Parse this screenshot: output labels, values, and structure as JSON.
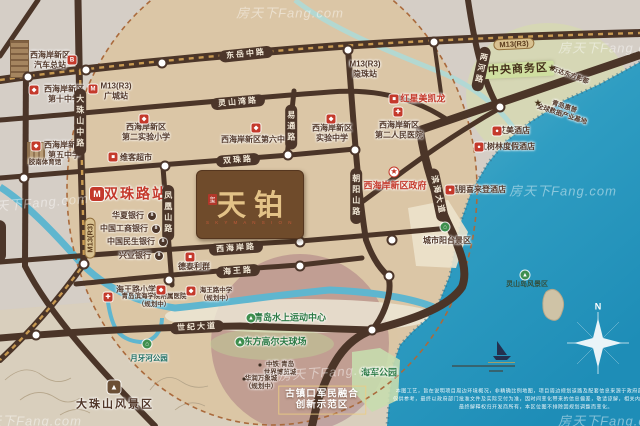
{
  "brand": {
    "seal": "玺",
    "title": "天铂",
    "subtitle": "S K Y   M A N S I O N"
  },
  "watermark_text": "房天下Fang.com",
  "colors": {
    "road": "#4b3528",
    "metro_dash": "#c89a52",
    "sea_top": "#5fb6cc",
    "sea_deep": "#1e8db7",
    "circle_fill": "#dbc6a3",
    "circle_border": "#aa6a3c",
    "accent_red": "#c4392b",
    "poi_brown": "#52382a"
  },
  "map": {
    "road_labels": [
      {
        "name": "road-label-dongyue-middle-rd",
        "lines": [
          "东岳中路"
        ],
        "x": 246,
        "y": 54,
        "rot": -6,
        "style": "capsule"
      },
      {
        "name": "road-label-lingshanwan-rd",
        "lines": [
          "灵山湾路"
        ],
        "x": 238,
        "y": 102,
        "rot": -5,
        "style": "capsule"
      },
      {
        "name": "road-label-shuangzhu-rd",
        "lines": [
          "双珠路"
        ],
        "x": 238,
        "y": 160,
        "rot": -4,
        "style": "capsule"
      },
      {
        "name": "road-label-xihaian-rd",
        "lines": [
          "西海岸路"
        ],
        "x": 236,
        "y": 248,
        "rot": -4,
        "style": "capsule"
      },
      {
        "name": "road-label-haiwang-rd",
        "lines": [
          "海王路"
        ],
        "x": 238,
        "y": 271,
        "rot": -4,
        "style": "capsule"
      },
      {
        "name": "road-label-shiji-ave",
        "lines": [
          "世纪大道"
        ],
        "x": 197,
        "y": 327,
        "rot": -3,
        "style": "capsule"
      },
      {
        "name": "road-label-binhai-ave",
        "lines": [
          "滨海大道"
        ],
        "x": 438,
        "y": 195,
        "rot": 78,
        "style": "capsule"
      },
      {
        "name": "road-label-dazhushan-middle-rd",
        "lines": [
          "大珠山中路"
        ],
        "x": 80,
        "y": 122,
        "rot": 0,
        "style": "capsule-v"
      },
      {
        "name": "road-label-fenghuangshan-rd",
        "lines": [
          "凤凰山路"
        ],
        "x": 168,
        "y": 213,
        "rot": 0,
        "style": "capsule-v"
      },
      {
        "name": "road-label-yitong-rd",
        "lines": [
          "易通路"
        ],
        "x": 291,
        "y": 127,
        "rot": 0,
        "style": "capsule-v"
      },
      {
        "name": "road-label-chaoyangshan-rd",
        "lines": [
          "朝阳山路"
        ],
        "x": 356,
        "y": 196,
        "rot": 0,
        "style": "capsule-v"
      },
      {
        "name": "road-label-lianghe-rd",
        "lines": [
          "两河路"
        ],
        "x": 481,
        "y": 69,
        "rot": 12,
        "style": "capsule-v"
      },
      {
        "name": "metro-badge-m13-top",
        "lines": [
          "M13(R3)"
        ],
        "x": 514,
        "y": 44,
        "rot": -3,
        "style": "metro"
      },
      {
        "name": "metro-badge-m13-vertical",
        "lines": [
          "M13(R3)"
        ],
        "x": 90,
        "y": 238,
        "rot": -90,
        "style": "metro"
      }
    ],
    "pois": [
      {
        "name": "poi-bus-terminal",
        "lines": [
          "西海岸新区",
          "汽车总站"
        ],
        "x": 50,
        "y": 60,
        "cls": "poi"
      },
      {
        "name": "poi-station-guangcheng",
        "lines": [
          "M13(R3)",
          "广城站"
        ],
        "x": 116,
        "y": 91,
        "cls": "poi"
      },
      {
        "name": "poi-no10-middle-school",
        "lines": [
          "西海岸新区",
          "第十中学"
        ],
        "x": 64,
        "y": 94,
        "cls": "poi"
      },
      {
        "name": "poi-no5-middle-school",
        "lines": [
          "西海岸新区",
          "第五中学"
        ],
        "x": 64,
        "y": 150,
        "cls": "poi"
      },
      {
        "name": "poi-jiaonan-gym",
        "lines": [
          "胶南体育馆"
        ],
        "x": 45,
        "y": 163,
        "cls": "tiny"
      },
      {
        "name": "poi-weike-market",
        "lines": [
          "维客超市"
        ],
        "x": 136,
        "y": 158,
        "cls": "poi"
      },
      {
        "name": "poi-no2-exp-primary",
        "lines": [
          "西海岸新区",
          "第二实验小学"
        ],
        "x": 146,
        "y": 132,
        "cls": "poi"
      },
      {
        "name": "poi-no6-middle-school",
        "lines": [
          "西海岸新区第六中学"
        ],
        "x": 257,
        "y": 140,
        "cls": "poi"
      },
      {
        "name": "poi-exp-middle-school",
        "lines": [
          "西海岸新区",
          "实验中学"
        ],
        "x": 332,
        "y": 133,
        "cls": "poi"
      },
      {
        "name": "poi-no2-peoples-hospital",
        "lines": [
          "西海岸新区",
          "第二人民医院"
        ],
        "x": 399,
        "y": 130,
        "cls": "poi"
      },
      {
        "name": "poi-station-yinzhu",
        "lines": [
          "M13(R3)",
          "隐珠站"
        ],
        "x": 365,
        "y": 69,
        "cls": "poi"
      },
      {
        "name": "poi-redstar-macalline",
        "lines": [
          "红星美凯龙"
        ],
        "x": 423,
        "y": 99,
        "cls": "red"
      },
      {
        "name": "poi-cbd",
        "lines": [
          "中央商务区"
        ],
        "x": 518,
        "y": 70,
        "cls": "cbd-badge",
        "rot": -3
      },
      {
        "name": "poi-wanda-movie-metropolis",
        "lines": [
          "万达东方影都"
        ],
        "x": 570,
        "y": 76,
        "cls": "tiny-brown",
        "rot": 20
      },
      {
        "name": "poi-hp-data-base",
        "lines": [
          "青岛惠普",
          "全球数据产业基地"
        ],
        "x": 563,
        "y": 111,
        "cls": "tiny-brown",
        "rot": 18
      },
      {
        "name": "poi-meridien-hotel",
        "lines": [
          "艾美酒店"
        ],
        "x": 514,
        "y": 131,
        "cls": "poi"
      },
      {
        "name": "poi-mangrove-resort-hotel",
        "lines": [
          "红树林度假酒店"
        ],
        "x": 507,
        "y": 147,
        "cls": "poi"
      },
      {
        "name": "poi-four-points-sheraton",
        "lines": [
          "福朋喜来登酒店"
        ],
        "x": 478,
        "y": 190,
        "cls": "poi"
      },
      {
        "name": "poi-district-government",
        "lines": [
          "西海岸新区政府"
        ],
        "x": 395,
        "y": 186,
        "cls": "red"
      },
      {
        "name": "poi-city-balcony-scenic",
        "lines": [
          "城市阳台景区"
        ],
        "x": 447,
        "y": 241,
        "cls": "poi"
      },
      {
        "name": "poi-shuangzhu-road-station",
        "lines": [
          "双珠路站"
        ],
        "x": 136,
        "y": 194,
        "cls": "station-red"
      },
      {
        "name": "poi-detailiqun",
        "lines": [
          "德泰利群"
        ],
        "x": 194,
        "y": 267,
        "cls": "poi"
      },
      {
        "name": "poi-haiwang-primary",
        "lines": [
          "海王路小学"
        ],
        "x": 136,
        "y": 290,
        "cls": "poi"
      },
      {
        "name": "poi-binhai-college-hospital",
        "lines": [
          "青岛滨海学院附属医院",
          "（规划中）"
        ],
        "x": 154,
        "y": 301,
        "cls": "tiny"
      },
      {
        "name": "poi-haiwang-middle",
        "lines": [
          "海王路中学",
          "（规划中）"
        ],
        "x": 216,
        "y": 295,
        "cls": "tiny"
      },
      {
        "name": "poi-water-sports-center",
        "lines": [
          "青岛水上运动中心"
        ],
        "x": 290,
        "y": 318,
        "cls": "green"
      },
      {
        "name": "poi-oriental-golf",
        "lines": [
          "东方高尔夫球场"
        ],
        "x": 275,
        "y": 342,
        "cls": "green"
      },
      {
        "name": "poi-expo-city",
        "lines": [
          "中铁·青岛",
          "世界博览城"
        ],
        "x": 280,
        "y": 369,
        "cls": "tiny-brown"
      },
      {
        "name": "poi-mixc",
        "lines": [
          "华润万象城",
          "（规划中）"
        ],
        "x": 261,
        "y": 383,
        "cls": "tiny-brown"
      },
      {
        "name": "poi-guzhenkou-demo-zone",
        "lines": [
          "古镇口军民融合",
          "创新示范区"
        ],
        "x": 322,
        "y": 400,
        "cls": "white-badge"
      },
      {
        "name": "poi-navy-park",
        "lines": [
          "海军公园"
        ],
        "x": 379,
        "y": 373,
        "cls": "green"
      },
      {
        "name": "poi-moon-river-park",
        "lines": [
          "月牙河公园"
        ],
        "x": 149,
        "y": 358,
        "cls": "teal"
      },
      {
        "name": "poi-dazhushan-scenic",
        "lines": [
          "大珠山风景区"
        ],
        "x": 115,
        "y": 405,
        "cls": "big-brown"
      },
      {
        "name": "poi-lingshan-island-scenic",
        "lines": [
          "灵山岛风景区"
        ],
        "x": 527,
        "y": 285,
        "cls": "sea-label"
      },
      {
        "name": "compass-n-label",
        "lines": [
          "N"
        ],
        "x": 598,
        "y": 307,
        "cls": "n-label"
      }
    ],
    "banks": [
      {
        "name": "poi-huaxia-bank",
        "text": "华夏银行",
        "x": 128,
        "y": 216,
        "bx": 152,
        "by": 216
      },
      {
        "name": "poi-icbc-bank",
        "text": "中国工商银行",
        "x": 124,
        "y": 229,
        "bx": 156,
        "by": 229
      },
      {
        "name": "poi-minsheng-bank",
        "text": "中国民生银行",
        "x": 131,
        "y": 242,
        "bx": 163,
        "by": 242
      },
      {
        "name": "poi-cib-bank",
        "text": "兴业银行",
        "x": 135,
        "y": 256,
        "bx": 159,
        "by": 256
      }
    ],
    "icons": [
      {
        "name": "bus-terminal-icon",
        "glyph": "B",
        "x": 72,
        "y": 60,
        "type": "red"
      },
      {
        "name": "metro-station-icon-guangcheng",
        "glyph": "M",
        "x": 93,
        "y": 89,
        "type": "metro"
      },
      {
        "name": "school-icon-no10",
        "glyph": "◆",
        "x": 34,
        "y": 90,
        "type": "red"
      },
      {
        "name": "school-icon-no5",
        "glyph": "◆",
        "x": 36,
        "y": 146,
        "type": "red"
      },
      {
        "name": "market-icon-weike",
        "glyph": "■",
        "x": 113,
        "y": 157,
        "type": "red"
      },
      {
        "name": "school-icon-no2-exp-primary",
        "glyph": "◆",
        "x": 144,
        "y": 119,
        "type": "red"
      },
      {
        "name": "school-icon-no6",
        "glyph": "◆",
        "x": 256,
        "y": 128,
        "type": "red"
      },
      {
        "name": "school-icon-exp-middle",
        "glyph": "◆",
        "x": 331,
        "y": 119,
        "type": "red"
      },
      {
        "name": "hospital-icon-no2",
        "glyph": "✚",
        "x": 398,
        "y": 112,
        "type": "red"
      },
      {
        "name": "mall-icon-redstar",
        "glyph": "■",
        "x": 394,
        "y": 99,
        "type": "red"
      },
      {
        "name": "hotel-icon-meridien",
        "glyph": "●",
        "x": 497,
        "y": 131,
        "type": "red"
      },
      {
        "name": "hotel-icon-mangrove",
        "glyph": "●",
        "x": 479,
        "y": 147,
        "type": "red"
      },
      {
        "name": "hotel-icon-sheraton",
        "glyph": "●",
        "x": 450,
        "y": 190,
        "type": "red"
      },
      {
        "name": "government-star-icon",
        "glyph": "★",
        "x": 394,
        "y": 172,
        "type": "gov"
      },
      {
        "name": "metro-station-icon-shuangzhu",
        "glyph": "M",
        "x": 97,
        "y": 194,
        "type": "metro-big"
      },
      {
        "name": "market-icon-detailiqun",
        "glyph": "■",
        "x": 190,
        "y": 257,
        "type": "red"
      },
      {
        "name": "school-icon-haiwang-primary",
        "glyph": "◆",
        "x": 161,
        "y": 290,
        "type": "red"
      },
      {
        "name": "hospital-icon-binhai-college",
        "glyph": "✚",
        "x": 108,
        "y": 297,
        "type": "red"
      },
      {
        "name": "school-icon-haiwang-middle",
        "glyph": "◆",
        "x": 191,
        "y": 291,
        "type": "red"
      },
      {
        "name": "star-icon-wanda",
        "glyph": "★",
        "x": 552,
        "y": 68,
        "type": "star"
      },
      {
        "name": "star-icon-hp-base",
        "glyph": "★",
        "x": 538,
        "y": 103,
        "type": "star"
      },
      {
        "name": "watersport-icon",
        "glyph": "▲",
        "x": 251,
        "y": 318,
        "type": "green"
      },
      {
        "name": "golf-icon",
        "glyph": "▲",
        "x": 240,
        "y": 342,
        "type": "green"
      },
      {
        "name": "pavilion-icon-moon-river",
        "glyph": "⌂",
        "x": 147,
        "y": 344,
        "type": "green"
      },
      {
        "name": "scenic-icon-city-balcony",
        "glyph": "⌂",
        "x": 445,
        "y": 227,
        "type": "green"
      },
      {
        "name": "island-icon-lingshan",
        "glyph": "▲",
        "x": 525,
        "y": 275,
        "type": "green"
      },
      {
        "name": "mountain-icon-dazhushan",
        "glyph": "▲",
        "x": 114,
        "y": 387,
        "type": "mountain"
      },
      {
        "name": "bullet-icon-expo",
        "glyph": "",
        "x": 260,
        "y": 365,
        "type": "dot"
      },
      {
        "name": "bullet-icon-mixc",
        "glyph": "",
        "x": 244,
        "y": 379,
        "type": "dot"
      }
    ],
    "station_dots": [
      [
        86,
        70
      ],
      [
        28,
        77
      ],
      [
        162,
        63
      ],
      [
        348,
        50
      ],
      [
        434,
        42
      ],
      [
        500,
        107
      ],
      [
        24,
        178
      ],
      [
        165,
        166
      ],
      [
        288,
        155
      ],
      [
        355,
        150
      ],
      [
        300,
        242
      ],
      [
        169,
        280
      ],
      [
        300,
        266
      ],
      [
        392,
        240
      ],
      [
        389,
        276
      ],
      [
        372,
        330
      ],
      [
        36,
        335
      ],
      [
        84,
        264
      ]
    ],
    "watermarks": [
      [
        290,
        12,
        0
      ],
      [
        612,
        47,
        0
      ],
      [
        35,
        202,
        -5
      ],
      [
        563,
        190,
        0
      ],
      [
        332,
        371,
        -4
      ],
      [
        612,
        420,
        0
      ],
      [
        28,
        420,
        0
      ]
    ],
    "disclaimer": [
      "本图工艺，旨在说明项目周边环境概况，非精确比例地图，项目周边规划道路及配套信息来源于政府部门公示文件，",
      "仅供参考，最终以政府部门批准文件及实际交付为准，因时间变化带来的信息偏差，敬请谅解，相关内容不作为要约，",
      "最终解释权归开发商所有，本区位图不排除因规划调整而变化。"
    ]
  }
}
